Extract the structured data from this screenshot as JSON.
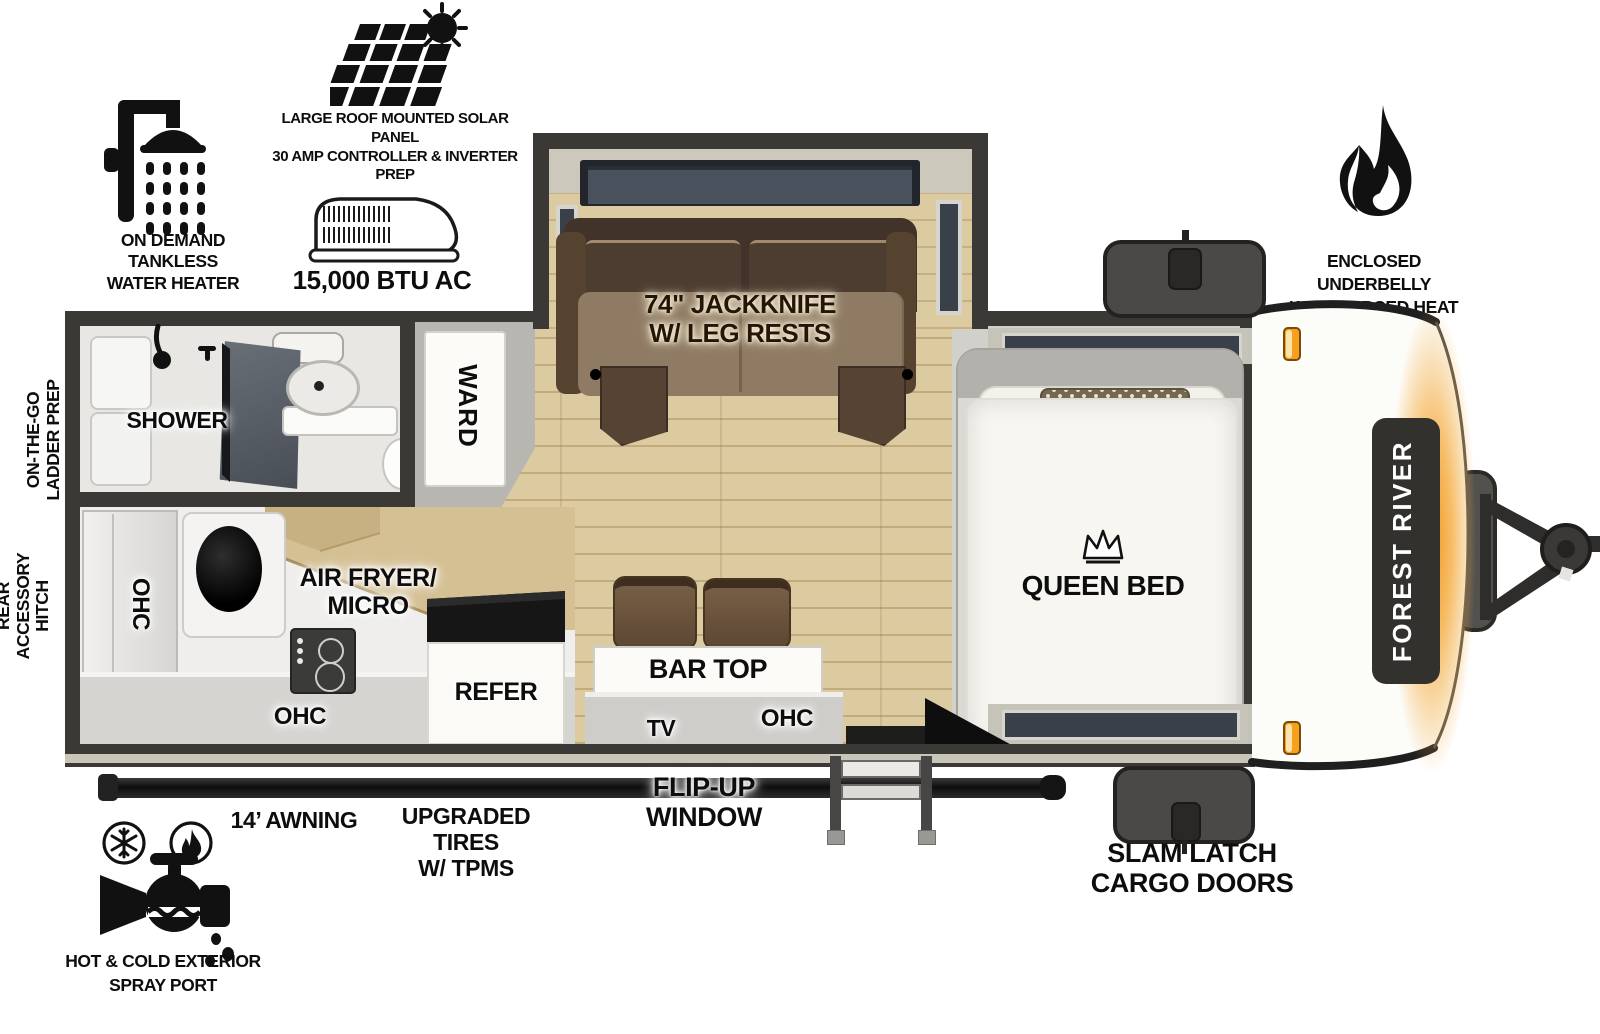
{
  "exterior_features": {
    "water_heater": "ON DEMAND\nTANKLESS\nWATER HEATER",
    "solar": "LARGE ROOF MOUNTED SOLAR PANEL\n30 AMP CONTROLLER & INVERTER PREP",
    "ac": "15,000 BTU AC",
    "underbelly": "ENCLOSED UNDERBELLY\nWITH FORCED HEAT",
    "spray_port": "HOT & COLD EXTERIOR\nSPRAY PORT",
    "awning": "14’ AWNING",
    "tires": "UPGRADED TIRES\nW/ TPMS",
    "flip_up_window": "FLIP-UP WINDOW",
    "cargo_doors": "SLAM LATCH\nCARGO DOORS",
    "ladder_prep": "ON-THE-GO\nLADDER PREP",
    "rear_hitch": "REAR\nACCESSORY\nHITCH"
  },
  "interior": {
    "shower": "SHOWER",
    "wardrobe": "WARD",
    "sofa": "74\" JACKKNIFE\nW/ LEG RESTS",
    "queen_bed": "QUEEN BED",
    "bar_top": "BAR TOP",
    "tv": "TV",
    "ohc_kitchen_wall": "OHC",
    "ohc_kitchen_lower": "OHC",
    "ohc_bar": "OHC",
    "air_fryer_micro": "AIR FRYER/\nMICRO",
    "refrigerator": "REFER"
  },
  "brand": {
    "front_cap_logo": "FOREST RIVER"
  },
  "colors": {
    "wall": "#3b3936",
    "floor_wood": "#dccaa0",
    "sofa_back": "#42332a",
    "sofa_seat": "#8f7a64",
    "glow_orange": "#f5ad42",
    "cargo_door": "#4b4947",
    "window_glass": "#39404a"
  }
}
